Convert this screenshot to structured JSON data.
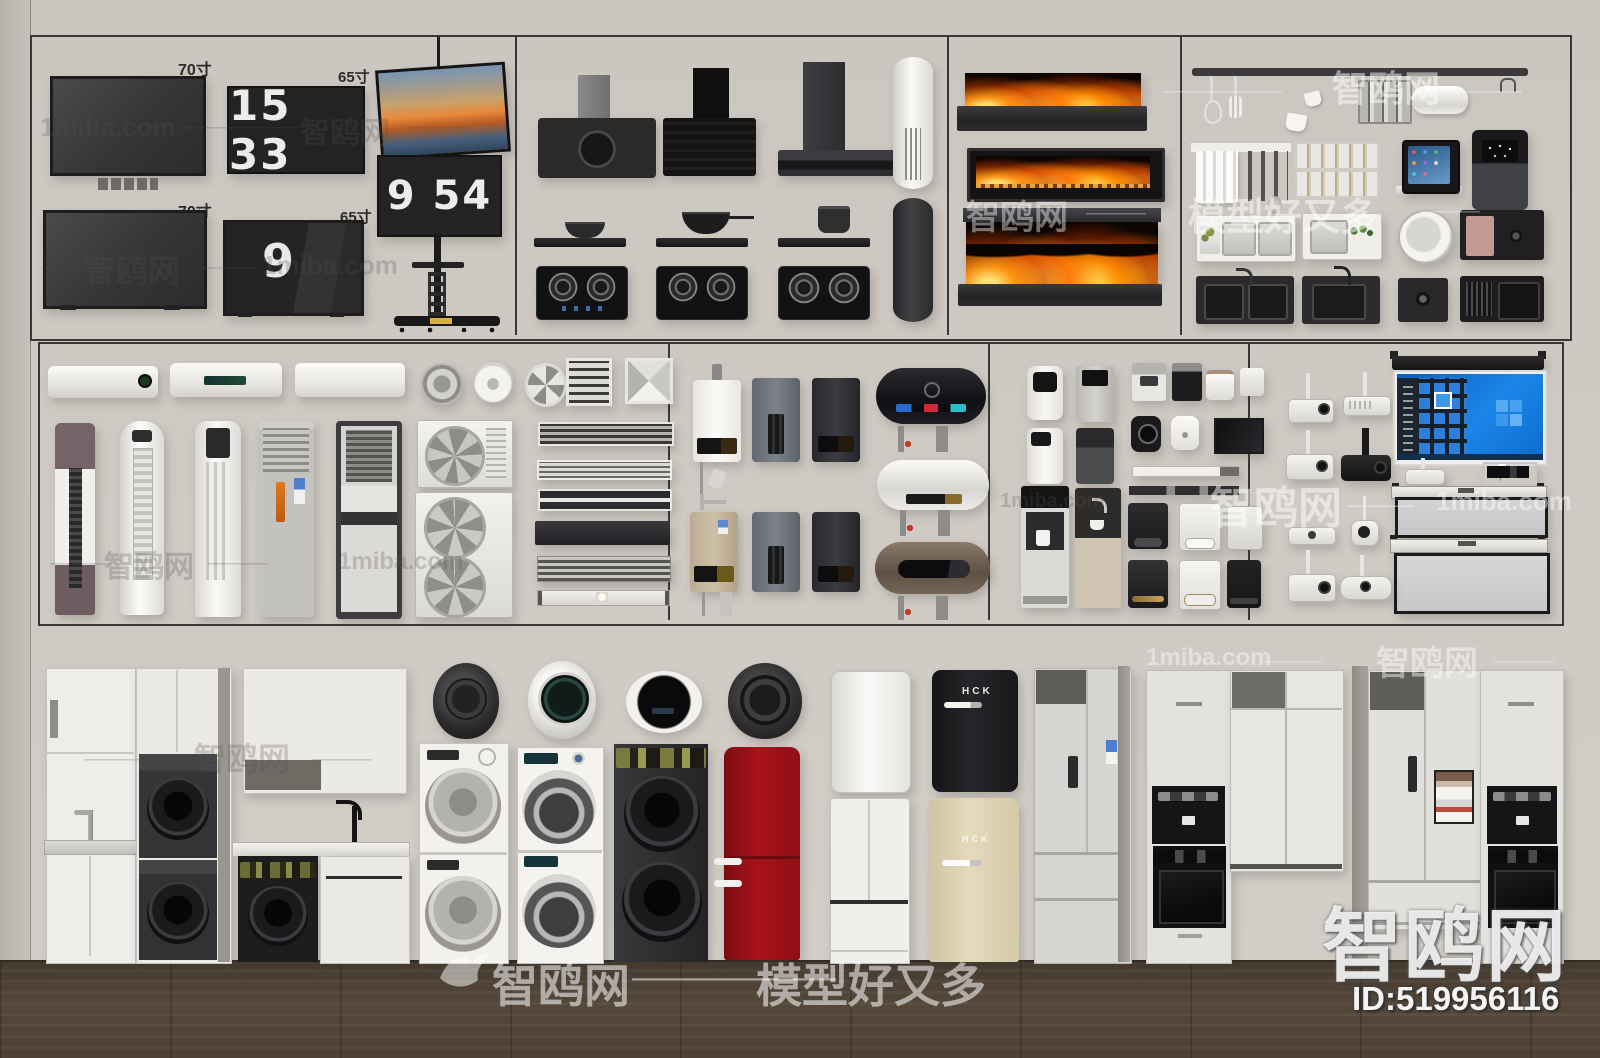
{
  "watermarks": {
    "site_en": "1miba.com",
    "site_cn": "智鸥网",
    "slogan": "模型好又多",
    "dashes": "——————",
    "dashes_short": "———",
    "model_id": "ID:519956116"
  },
  "labels": {
    "tv_70": "70寸",
    "tv_65": "65寸"
  },
  "clocks": {
    "flip_1": "15 33",
    "flip_2": "9 54",
    "flip_3": "9"
  },
  "brands": {
    "retro_fridge": "HCK"
  },
  "colors": {
    "wall": "#cbc6c0",
    "floor_wood": "#4f4337",
    "flame_orange": "#ff8c00",
    "fridge_red": "#9e1016",
    "fridge_cream": "#ddd2b0",
    "windows_blue": "#1177d4"
  }
}
